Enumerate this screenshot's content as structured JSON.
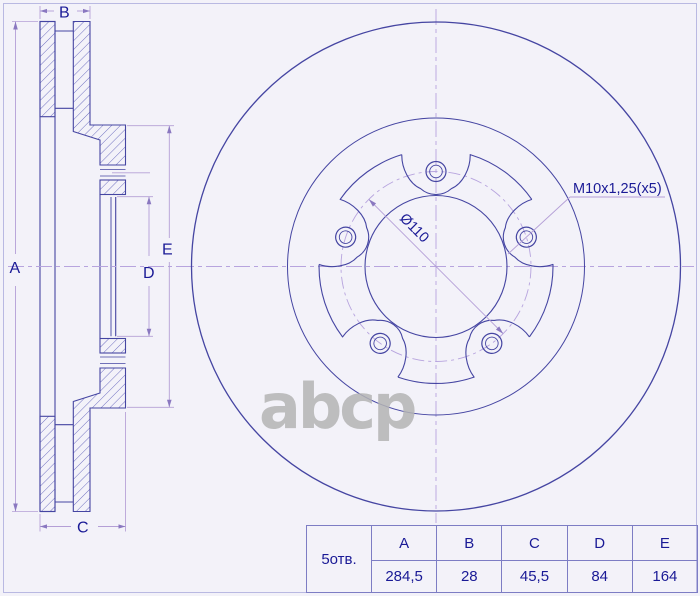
{
  "side_view": {
    "dim_labels": {
      "a": "A",
      "b": "B",
      "c": "C",
      "d": "D",
      "e": "E"
    }
  },
  "front_view": {
    "pcd_label": "Ø110",
    "thread_label": "M10x1,25(x5)"
  },
  "watermark": {
    "text": "abcp"
  },
  "spec_table": {
    "holes_label": "5отв.",
    "columns": [
      "A",
      "B",
      "C",
      "D",
      "E"
    ],
    "values": [
      "284,5",
      "28",
      "45,5",
      "84",
      "164"
    ]
  },
  "colors": {
    "line": "#4545a2",
    "dimension": "#b49fd6",
    "arrow": "#8a78c0",
    "text": "#1a1a96",
    "hatch": "#6363bb",
    "centerline": "#b7a4de",
    "table_border": "#7d7dc4",
    "frame": "#b9b9e2",
    "watermark": "#b4b4b4",
    "background": "#f3f2f9"
  }
}
